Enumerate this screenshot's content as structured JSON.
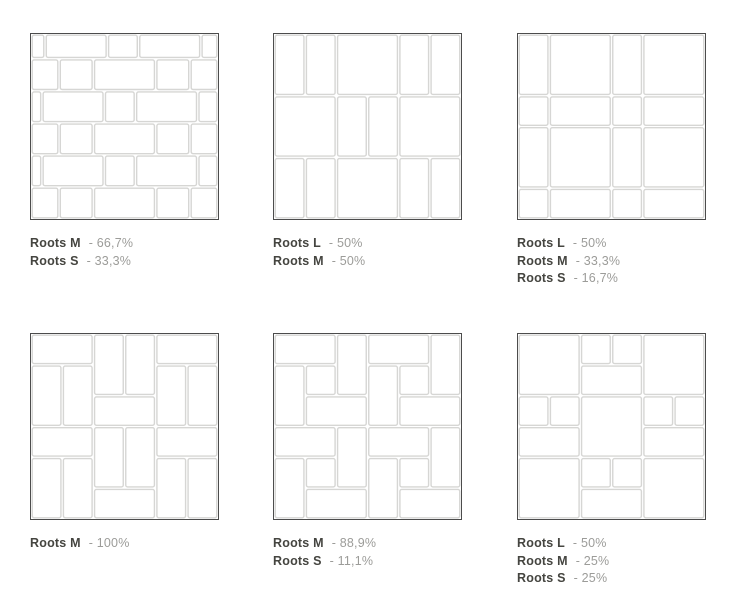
{
  "colors": {
    "background": "#ffffff",
    "diagram_border": "#4c4c4c",
    "grout_line": "#d6d6d4",
    "tile_fill": "#ffffff",
    "label_name": "#454540",
    "label_value": "#9c9c99"
  },
  "figures": [
    {
      "id": "running-bond-m-s",
      "legend": [
        {
          "name": "Roots M",
          "value": "- 66,7%"
        },
        {
          "name": "Roots S",
          "value": "- 33,3%"
        }
      ],
      "tiles": [
        [
          0,
          0,
          0.45,
          0.8
        ],
        [
          0.45,
          0,
          2,
          0.8
        ],
        [
          2.45,
          0,
          1,
          0.8
        ],
        [
          3.45,
          0,
          2,
          0.8
        ],
        [
          5.45,
          0,
          0.55,
          0.8
        ],
        [
          0,
          0.8,
          0.9,
          1.04
        ],
        [
          0.9,
          0.8,
          1.1,
          1.04
        ],
        [
          2,
          0.8,
          2,
          1.04
        ],
        [
          4,
          0.8,
          1.1,
          1.04
        ],
        [
          5.1,
          0.8,
          0.9,
          1.04
        ],
        [
          0,
          1.84,
          0.35,
          1.04
        ],
        [
          0.35,
          1.84,
          2,
          1.04
        ],
        [
          2.35,
          1.84,
          1,
          1.04
        ],
        [
          3.35,
          1.84,
          2,
          1.04
        ],
        [
          5.35,
          1.84,
          0.65,
          1.04
        ],
        [
          0,
          2.88,
          0.9,
          1.04
        ],
        [
          0.9,
          2.88,
          1.1,
          1.04
        ],
        [
          2,
          2.88,
          2,
          1.04
        ],
        [
          4,
          2.88,
          1.1,
          1.04
        ],
        [
          5.1,
          2.88,
          0.9,
          1.04
        ],
        [
          0,
          3.92,
          0.35,
          1.04
        ],
        [
          0.35,
          3.92,
          2,
          1.04
        ],
        [
          2.35,
          3.92,
          1,
          1.04
        ],
        [
          3.35,
          3.92,
          2,
          1.04
        ],
        [
          5.35,
          3.92,
          0.65,
          1.04
        ],
        [
          0,
          4.96,
          0.9,
          1.04
        ],
        [
          0.9,
          4.96,
          1.1,
          1.04
        ],
        [
          2,
          4.96,
          2,
          1.04
        ],
        [
          4,
          4.96,
          1.1,
          1.04
        ],
        [
          5.1,
          4.96,
          0.9,
          1.04
        ]
      ]
    },
    {
      "id": "rows-l-m",
      "legend": [
        {
          "name": "Roots L",
          "value": "- 50%"
        },
        {
          "name": "Roots M",
          "value": "- 50%"
        }
      ],
      "tiles": [
        [
          0,
          0,
          1,
          2
        ],
        [
          1,
          0,
          1,
          2
        ],
        [
          2,
          0,
          2,
          2
        ],
        [
          4,
          0,
          1,
          2
        ],
        [
          5,
          0,
          1,
          2
        ],
        [
          0,
          2,
          2,
          2
        ],
        [
          2,
          2,
          1,
          2
        ],
        [
          3,
          2,
          1,
          2
        ],
        [
          4,
          2,
          2,
          2
        ],
        [
          0,
          4,
          1,
          2
        ],
        [
          1,
          4,
          1,
          2
        ],
        [
          2,
          4,
          2,
          2
        ],
        [
          4,
          4,
          1,
          2
        ],
        [
          5,
          4,
          1,
          2
        ]
      ]
    },
    {
      "id": "modular-grid-l-m-s",
      "legend": [
        {
          "name": "Roots L",
          "value": "- 50%"
        },
        {
          "name": "Roots M",
          "value": "- 33,3%"
        },
        {
          "name": "Roots S",
          "value": "- 16,7%"
        }
      ],
      "tiles": [
        [
          0,
          0,
          1,
          2
        ],
        [
          1,
          0,
          2,
          2
        ],
        [
          3,
          0,
          1,
          2
        ],
        [
          4,
          0,
          2,
          2
        ],
        [
          0,
          2,
          1,
          1
        ],
        [
          1,
          2,
          2,
          1
        ],
        [
          3,
          2,
          1,
          1
        ],
        [
          4,
          2,
          2,
          1
        ],
        [
          0,
          3,
          1,
          2
        ],
        [
          1,
          3,
          2,
          2
        ],
        [
          3,
          3,
          1,
          2
        ],
        [
          4,
          3,
          2,
          2
        ],
        [
          0,
          5,
          1,
          1
        ],
        [
          1,
          5,
          2,
          1
        ],
        [
          3,
          5,
          1,
          1
        ],
        [
          4,
          5,
          2,
          1
        ]
      ]
    },
    {
      "id": "basketweave-m",
      "legend": [
        {
          "name": "Roots M",
          "value": "- 100%"
        }
      ],
      "tiles": [
        [
          0,
          0,
          2,
          1
        ],
        [
          0,
          1,
          1,
          2
        ],
        [
          1,
          1,
          1,
          2
        ],
        [
          2,
          0,
          1,
          2
        ],
        [
          3,
          0,
          1,
          2
        ],
        [
          2,
          2,
          2,
          1
        ],
        [
          4,
          0,
          2,
          1
        ],
        [
          4,
          1,
          1,
          2
        ],
        [
          5,
          1,
          1,
          2
        ],
        [
          0,
          3,
          2,
          1
        ],
        [
          0,
          4,
          1,
          2
        ],
        [
          1,
          4,
          1,
          2
        ],
        [
          2,
          3,
          1,
          2
        ],
        [
          3,
          3,
          1,
          2
        ],
        [
          2,
          5,
          2,
          1
        ],
        [
          4,
          3,
          2,
          1
        ],
        [
          4,
          4,
          1,
          2
        ],
        [
          5,
          4,
          1,
          2
        ]
      ]
    },
    {
      "id": "pinwheel-m-s",
      "legend": [
        {
          "name": "Roots M",
          "value": "- 88,9%"
        },
        {
          "name": "Roots S",
          "value": "- 11,1%"
        }
      ],
      "tiles": [
        [
          0,
          0,
          2,
          1
        ],
        [
          2,
          0,
          1,
          2
        ],
        [
          0,
          1,
          1,
          2
        ],
        [
          1,
          2,
          2,
          1
        ],
        [
          1,
          1,
          1,
          1
        ],
        [
          3,
          0,
          2,
          1
        ],
        [
          5,
          0,
          1,
          2
        ],
        [
          3,
          1,
          1,
          2
        ],
        [
          4,
          2,
          2,
          1
        ],
        [
          4,
          1,
          1,
          1
        ],
        [
          0,
          3,
          2,
          1
        ],
        [
          2,
          3,
          1,
          2
        ],
        [
          0,
          4,
          1,
          2
        ],
        [
          1,
          5,
          2,
          1
        ],
        [
          1,
          4,
          1,
          1
        ],
        [
          3,
          3,
          2,
          1
        ],
        [
          5,
          3,
          1,
          2
        ],
        [
          3,
          4,
          1,
          2
        ],
        [
          4,
          5,
          2,
          1
        ],
        [
          4,
          4,
          1,
          1
        ]
      ]
    },
    {
      "id": "checker-l-m-s",
      "legend": [
        {
          "name": "Roots L",
          "value": "- 50%"
        },
        {
          "name": "Roots M",
          "value": "- 25%"
        },
        {
          "name": "Roots S",
          "value": "- 25%"
        }
      ],
      "tiles": [
        [
          0,
          0,
          2,
          2
        ],
        [
          4,
          0,
          2,
          2
        ],
        [
          2,
          2,
          2,
          2
        ],
        [
          0,
          4,
          2,
          2
        ],
        [
          4,
          4,
          2,
          2
        ],
        [
          2,
          0,
          1,
          1
        ],
        [
          3,
          0,
          1,
          1
        ],
        [
          2,
          1,
          2,
          1
        ],
        [
          0,
          2,
          1,
          1
        ],
        [
          1,
          2,
          1,
          1
        ],
        [
          0,
          3,
          2,
          1
        ],
        [
          4,
          2,
          1,
          1
        ],
        [
          5,
          2,
          1,
          1
        ],
        [
          4,
          3,
          2,
          1
        ],
        [
          2,
          4,
          1,
          1
        ],
        [
          3,
          4,
          1,
          1
        ],
        [
          2,
          5,
          2,
          1
        ]
      ]
    }
  ]
}
